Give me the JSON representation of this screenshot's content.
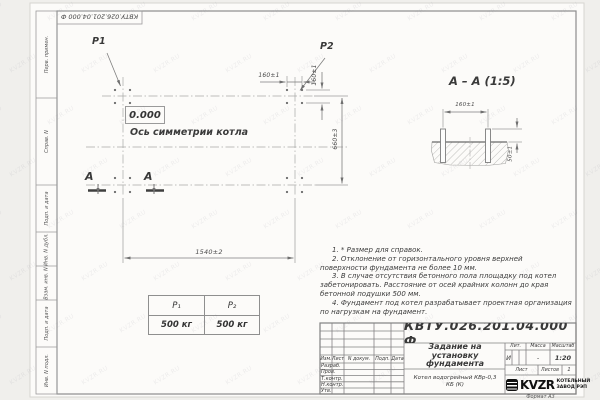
{
  "watermark": {
    "text": "KVZR.RU"
  },
  "sheet": {
    "stamp_designation": "КВТУ.026.201.04.000  Ф",
    "format_label": "Формат А3"
  },
  "margin_column": {
    "labels": [
      "Перв. примен.",
      "Справ. N",
      "Подп. и дата",
      "Инв. N дубл.",
      "Взам. инв. N",
      "Подп. и дата",
      "Инв. N подл."
    ]
  },
  "plan": {
    "load_label_1": "P1",
    "load_label_2": "P2",
    "level_mark": "0.000",
    "axis_label": "Ось симметрии котла",
    "dim_bolt_spacing_h": "160±1",
    "dim_bolt_spacing_v": "160±1",
    "dim_length": "1540±2",
    "dim_width": "660±3",
    "section_mark_left": "А",
    "section_mark_right": "А"
  },
  "section_view": {
    "title": "А – А (1:5)",
    "dim_bolt_spacing": "160±1",
    "dim_protrusion": "50±1"
  },
  "load_table": {
    "headers": [
      "Р₁",
      "Р₂"
    ],
    "values": [
      "500 кг",
      "500 кг"
    ]
  },
  "notes": {
    "items": [
      "1. * Размер для справок.",
      "2. Отклонение от горизонтального уровня верхней поверхности фундамента не более 10 мм.",
      "3. В случае отсутствия бетонного пола площадку под котел забетонировать. Расстояние от осей крайних колонн до края бетонной подушки 500 мм.",
      "4. Фундамент под котел разрабатывает проектная организация по нагрузкам на фундамент."
    ]
  },
  "title_block": {
    "designation": "КВТУ.026.201.04.000  Ф",
    "document_title": "Задание на установку фундамента",
    "product_name": "Котел водогрейный КВр-0,3 КБ (К)",
    "columns": [
      "Изм.",
      "Лист",
      "N докум.",
      "Подп.",
      "Дата"
    ],
    "signature_rows": [
      "Разраб.",
      "Пров.",
      "Т.контр.",
      "Н.контр.",
      "Утв."
    ],
    "lit_label": "Лит.",
    "mass_label": "Масса",
    "scale_label": "Масштаб",
    "lit_value": "И",
    "mass_value": "-",
    "scale_value": "1:20",
    "sheet_label": "Лист",
    "sheets_label": "Листов",
    "sheets_value": "1",
    "logo_text": "KVZR",
    "company_line1": "КОТЕЛЬНЫЙ",
    "company_line2": "ЗАВОД РЭП"
  }
}
